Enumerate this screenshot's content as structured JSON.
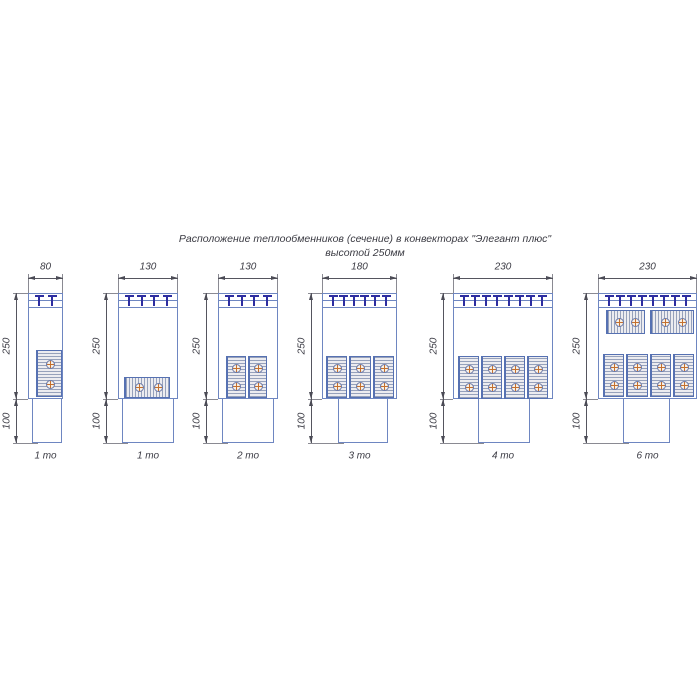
{
  "title": {
    "line1": "Расположение теплообменников (сечение) в конвекторах \"Элегант плюс\"",
    "line2": "высотой 250мм"
  },
  "dimensions": {
    "body_height_mm": "250",
    "duct_height_mm": "100"
  },
  "convectors": [
    {
      "width_mm": "80",
      "caption": "1 то",
      "heat_exchangers_total": 1
    },
    {
      "width_mm": "130",
      "caption": "1 то",
      "heat_exchangers_total": 1
    },
    {
      "width_mm": "130",
      "caption": "2 то",
      "heat_exchangers_total": 2
    },
    {
      "width_mm": "180",
      "caption": "3 то",
      "heat_exchangers_total": 3
    },
    {
      "width_mm": "230",
      "caption": "4 то",
      "heat_exchangers_total": 4
    },
    {
      "width_mm": "230",
      "caption": "6 то",
      "heat_exchangers_total": 6
    }
  ],
  "colors": {
    "outline_blue": "#6e86c1",
    "exchanger_border": "#5671b2",
    "grille_tee": "#2d2da0",
    "tube_cross": "#c4702f",
    "dimension_line": "#55555e",
    "text": "#3b3b44"
  }
}
